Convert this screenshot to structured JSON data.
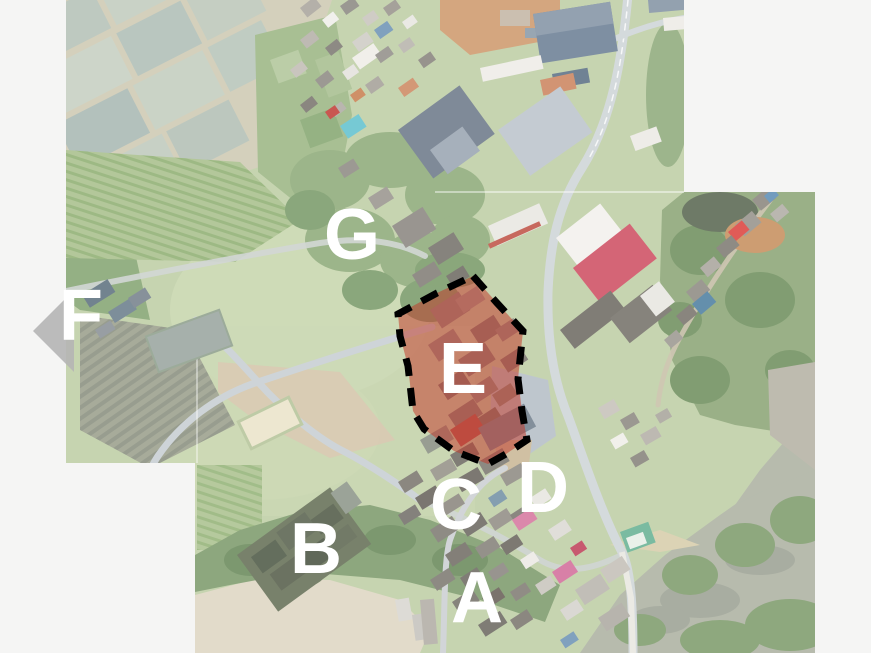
{
  "figure": {
    "description": "aerial orthophoto mosaic with labeled regions",
    "background_color": "#f5f5f4"
  },
  "markers": [
    {
      "label": "A",
      "x": 477,
      "y": 601
    },
    {
      "label": "B",
      "x": 316,
      "y": 552
    },
    {
      "label": "C",
      "x": 456,
      "y": 508
    },
    {
      "label": "D",
      "x": 543,
      "y": 491
    },
    {
      "label": "E",
      "x": 463,
      "y": 372
    },
    {
      "label": "F",
      "x": 81,
      "y": 319
    },
    {
      "label": "G",
      "x": 352,
      "y": 238
    }
  ],
  "overlay": {
    "highlighted_region_label": "E",
    "polygon_points": "473,276 497,303 523,331 518,379 522,411 527,440 506,454 488,464 454,451 424,429 413,411 408,366 400,336 398,314 437,293",
    "fill_color": "#c23728",
    "fill_opacity": 0.52,
    "stroke_color": "#000000",
    "stroke_width": 7,
    "dash_pattern": "18 12",
    "marker_color": "#ffffff",
    "arrow_points": "33,331 74,290 74,372",
    "arrow_color": "#b5b5b5"
  }
}
